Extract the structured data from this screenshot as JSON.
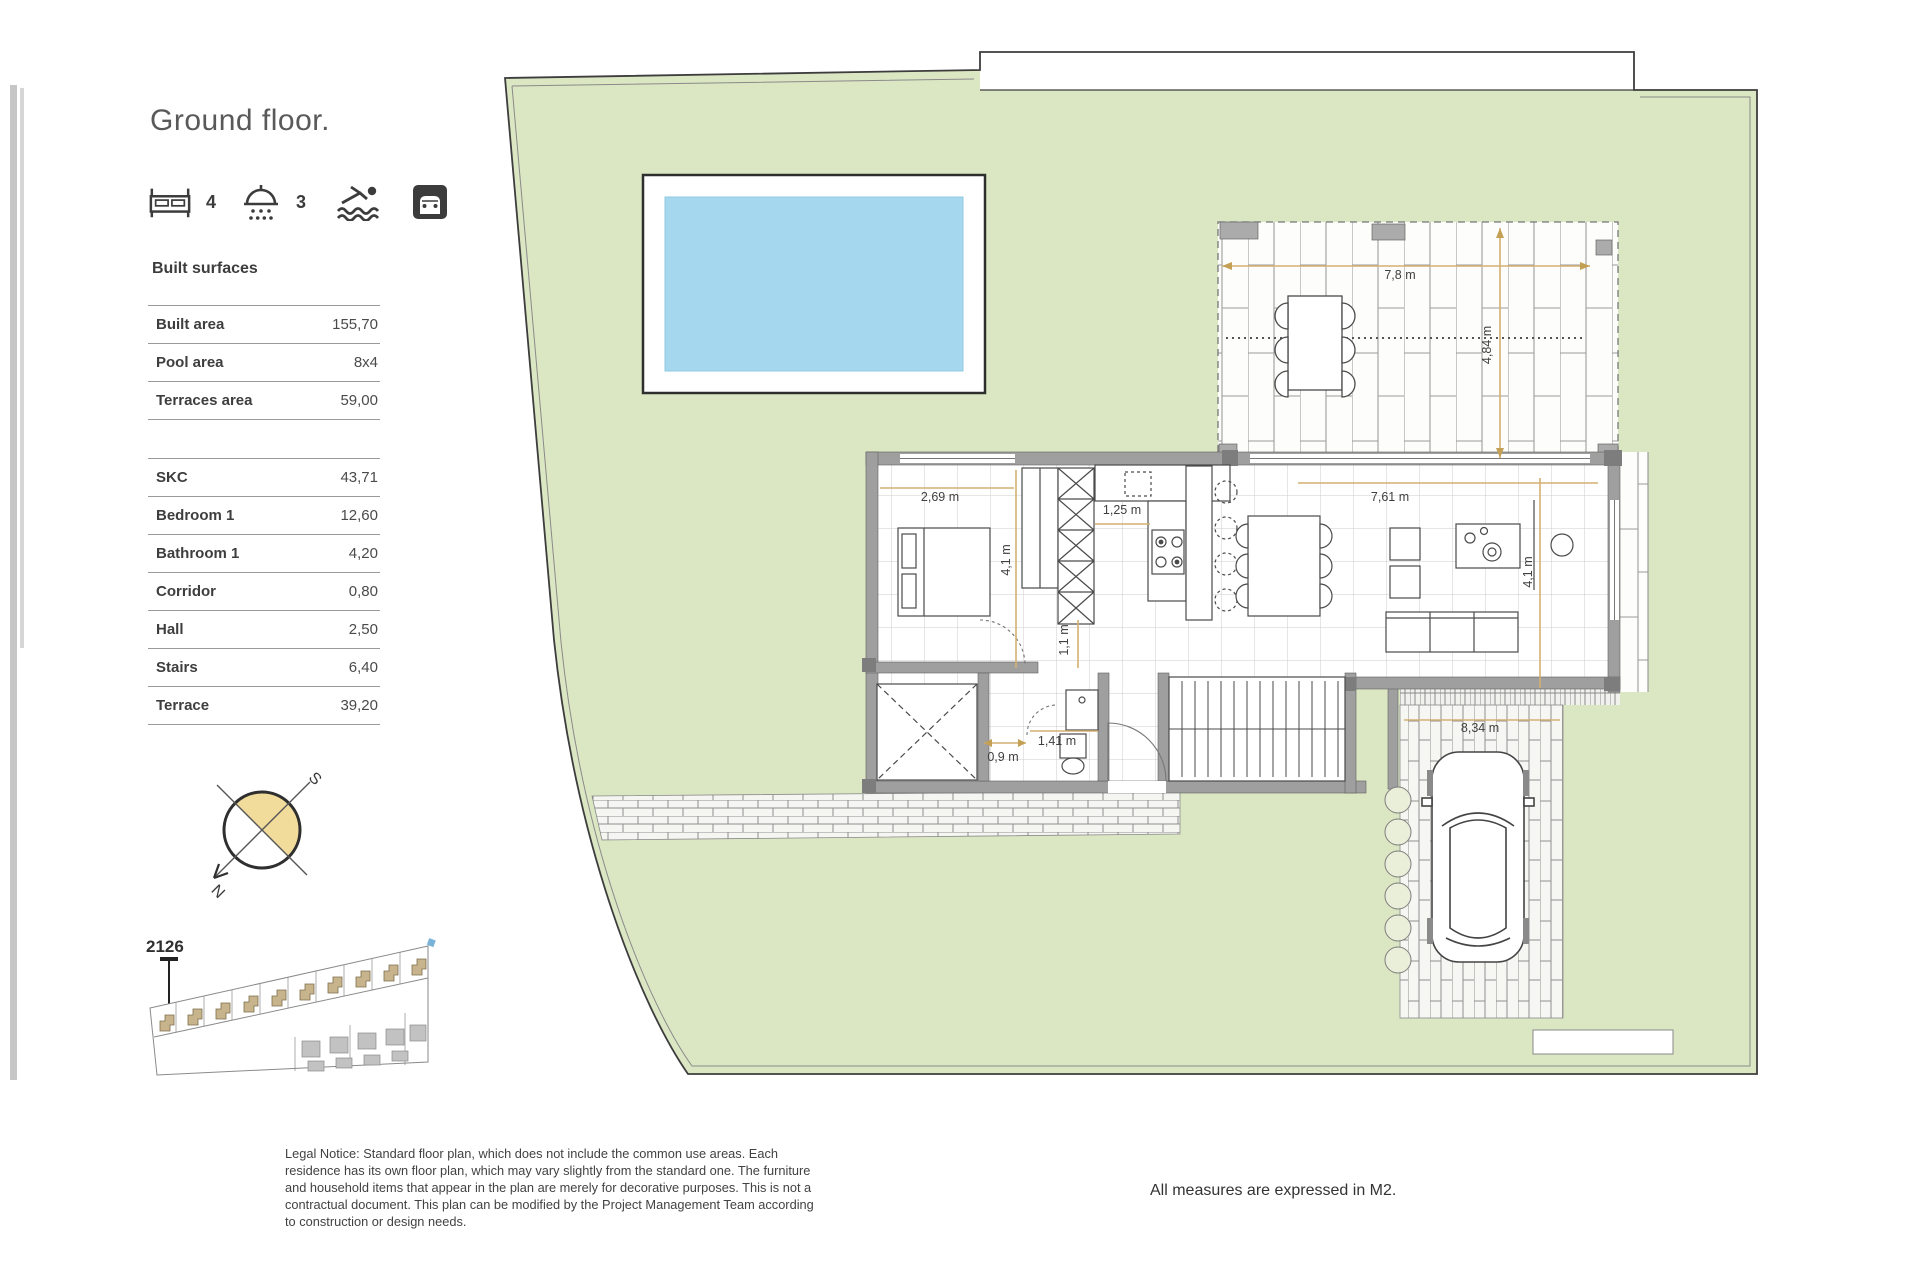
{
  "page": {
    "title": "Ground floor."
  },
  "stats": {
    "bedrooms": "4",
    "bathrooms": "3"
  },
  "surfaces": {
    "heading": "Built surfaces",
    "summary": [
      {
        "label": "Built area",
        "value": "155,70"
      },
      {
        "label": "Pool area",
        "value": "8x4"
      },
      {
        "label": "Terraces area",
        "value": "59,00"
      }
    ],
    "rooms": [
      {
        "label": "SKC",
        "value": "43,71"
      },
      {
        "label": "Bedroom 1",
        "value": "12,60"
      },
      {
        "label": "Bathroom 1",
        "value": "4,20"
      },
      {
        "label": "Corridor",
        "value": "0,80"
      },
      {
        "label": "Hall",
        "value": "2,50"
      },
      {
        "label": "Stairs",
        "value": "6,40"
      },
      {
        "label": "Terrace",
        "value": "39,20"
      }
    ]
  },
  "compass": {
    "north": "N",
    "south": "S"
  },
  "site_plan": {
    "unit": "2126"
  },
  "dimensions": {
    "terrace_w": "7,8 m",
    "terrace_h": "4,84 m",
    "bedroom_w": "2,69 m",
    "bedroom_h": "4,1 m",
    "kitchen": "1,25 m",
    "corridor": "1,1 m",
    "hall": "0,9 m",
    "bath": "1,41 m",
    "living_w": "7,61 m",
    "living_h": "4,1 m",
    "driveway": "8,34 m"
  },
  "notes": {
    "legal": "Legal Notice: Standard floor plan, which does not include the common use areas. Each residence has its own floor plan, which may vary slightly from the standard one. The furniture and household items that appear in the plan are merely for decorative purposes. This is not a contractual document. This plan can be modified by the Project Management Team according to construction or design needs.",
    "measures": "All measures are expressed in M2."
  },
  "colors": {
    "garden": "#dbe6c3",
    "pool": "#a5d8ef",
    "dim_line": "#d3b172",
    "compass_fill": "#f2dc9b",
    "site_house": "#c8b48c"
  }
}
